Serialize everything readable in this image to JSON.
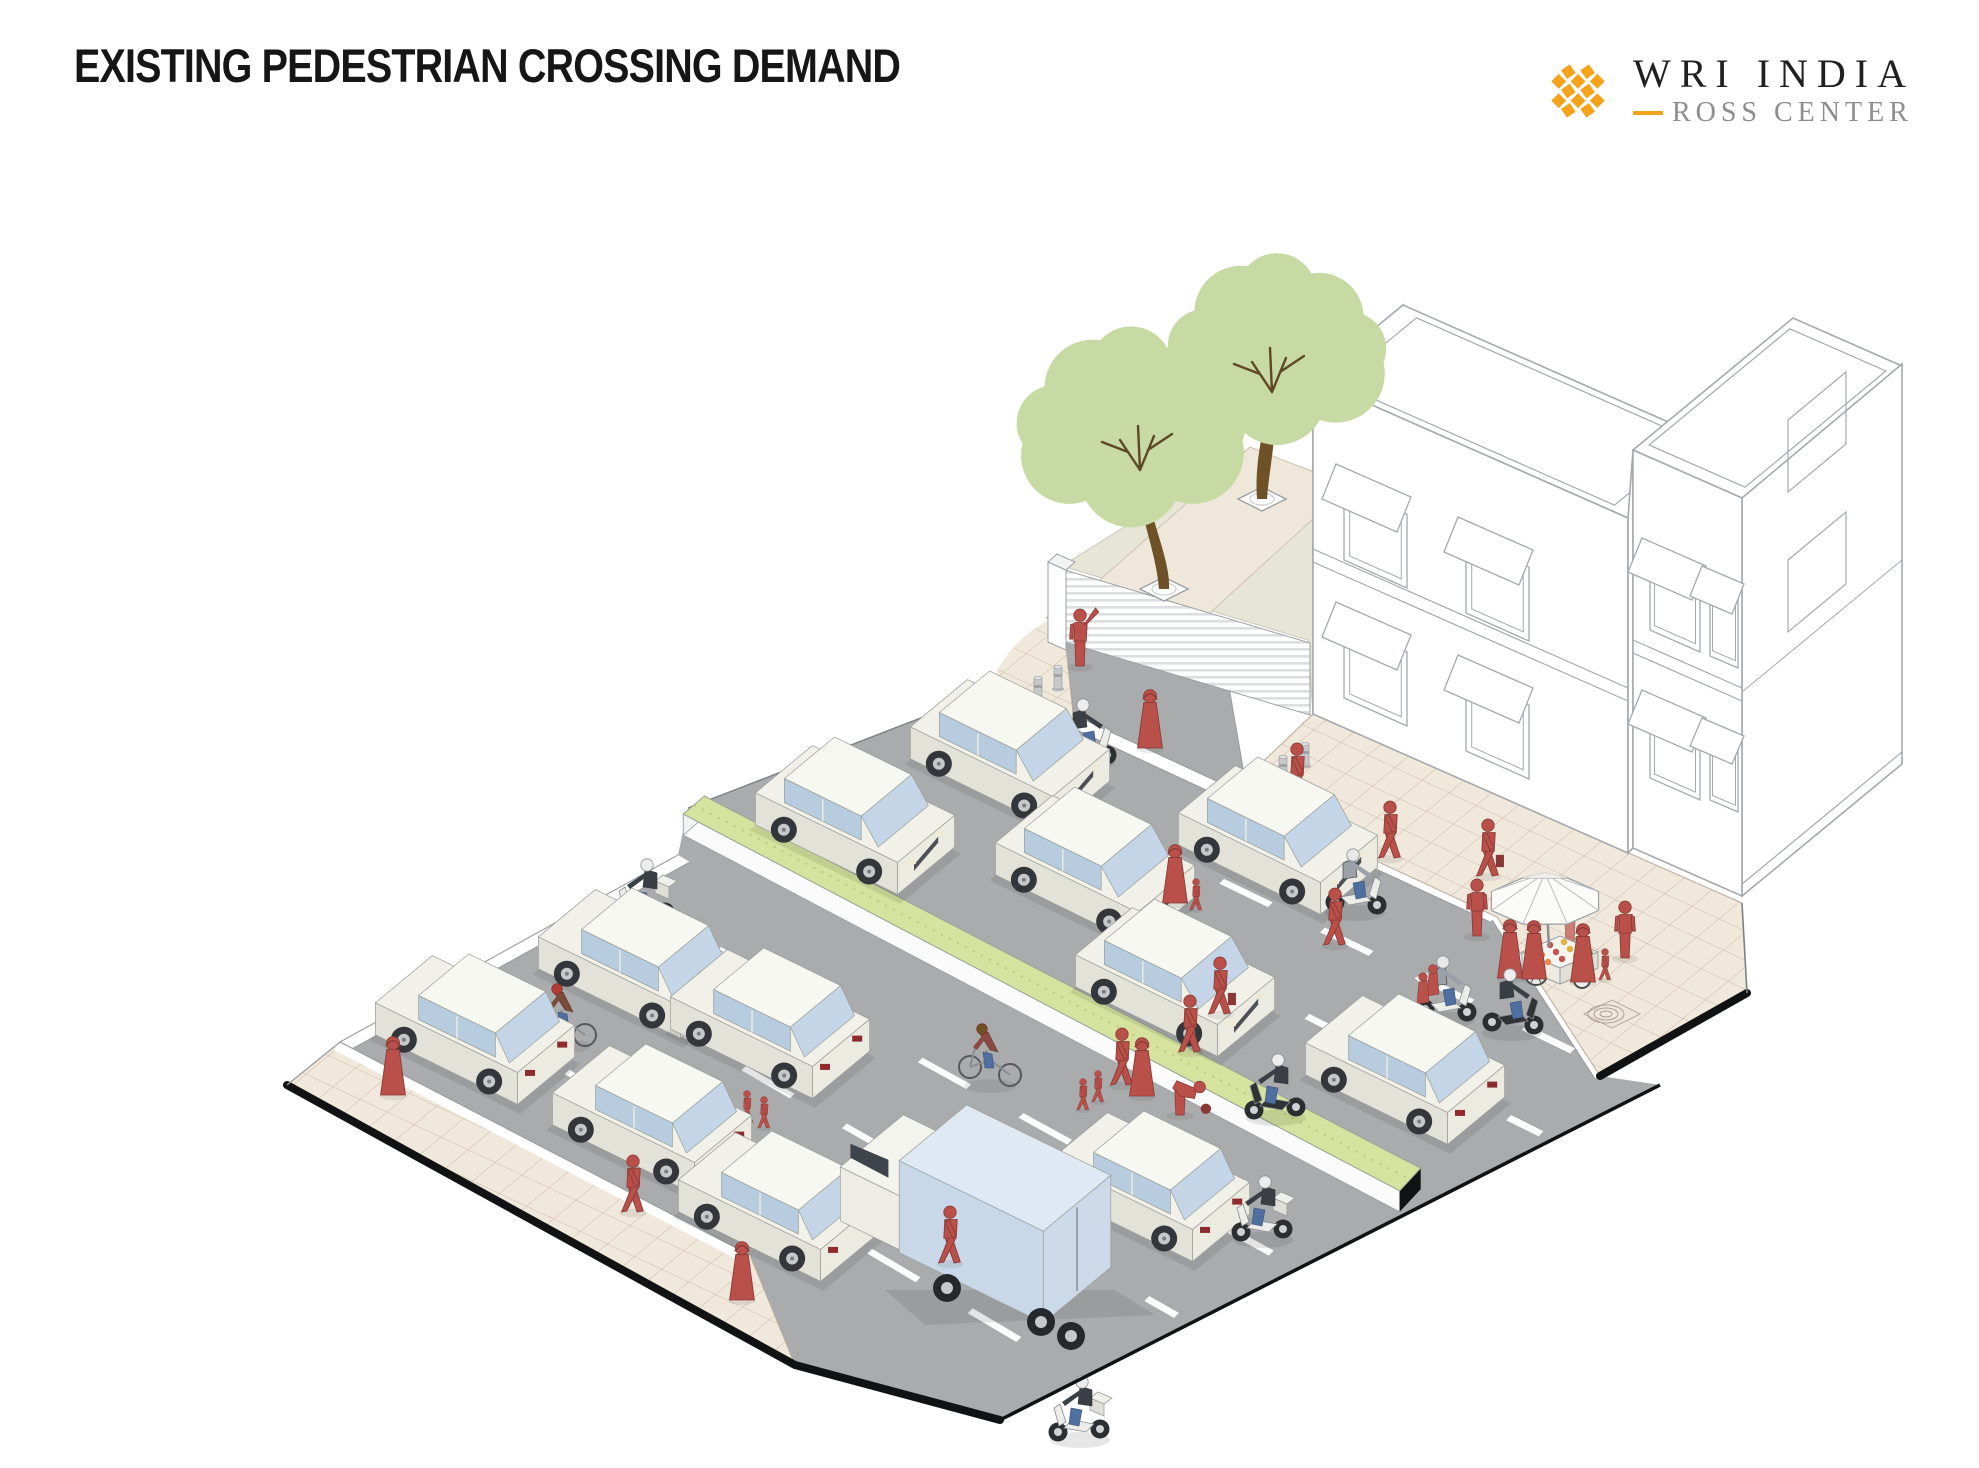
{
  "header": {
    "title": "EXISTING PEDESTRIAN CROSSING DEMAND"
  },
  "logo": {
    "line1": "WRI INDIA",
    "line2": "ROSS CENTER",
    "accent_gold": "#F5A31C",
    "text_dark": "#221f20",
    "text_gray": "#8d8d8d"
  },
  "scene": {
    "description": "Isometric street illustration of pedestrians crossing a busy divided road mid-block near a gated compound, trees, buildings and a street vendor",
    "colors": {
      "road": "#A9ABAD",
      "sidewalk": "#F0E8DB",
      "sidewalk_grid": "#CDB2A6",
      "path_tan": "#EFE7D9",
      "compound_green": "#E7E5D6",
      "median_green": "#D6E39E",
      "people_red": "#B9504A",
      "people_red_dark": "#8A3835",
      "tree_green": "#C8DAA4",
      "trunk_brown": "#6E5127",
      "car_body": "#EFEFE7",
      "car_glass": "#B7CCDF",
      "truck_box": "#C8D8E8",
      "building_line": "#A5A9AD",
      "edge_black": "#111214",
      "lane_white": "#FDFDFD"
    },
    "counts": {
      "cars": 12,
      "two_wheelers": 9,
      "bicycles": 2,
      "trucks": 1,
      "pedestrians": 30,
      "trees": 2,
      "bollards": 5
    },
    "median": {
      "u0": 142,
      "u1": 938,
      "v0": 338,
      "v1": 366,
      "wallH": 21
    },
    "lane_markings": [
      {
        "v": 175,
        "u0": 245,
        "u1": 975
      },
      {
        "v": 258,
        "u0": 185,
        "u1": 1005
      },
      {
        "v": 475,
        "u0": 160,
        "u1": 900
      },
      {
        "v": 570,
        "u0": 155,
        "u1": 860
      },
      {
        "v": 665,
        "u0": 150,
        "u1": 820
      }
    ],
    "cars": [
      {
        "x": 1010,
        "y": 772,
        "d": 1
      },
      {
        "x": 855,
        "y": 838,
        "d": 1
      },
      {
        "x": 1095,
        "y": 888,
        "d": 1
      },
      {
        "x": 1175,
        "y": 1000,
        "d": 1
      },
      {
        "x": 1278,
        "y": 858,
        "d": 1
      },
      {
        "x": 1405,
        "y": 1088,
        "d": -1
      },
      {
        "x": 475,
        "y": 1048,
        "d": -1
      },
      {
        "x": 638,
        "y": 982,
        "d": -1
      },
      {
        "x": 652,
        "y": 1138,
        "d": -1
      },
      {
        "x": 770,
        "y": 1042,
        "d": -1
      },
      {
        "x": 778,
        "y": 1225,
        "d": -1
      },
      {
        "x": 1150,
        "y": 1205,
        "d": -1
      }
    ],
    "trucks": [
      {
        "x": 1005,
        "y": 1260,
        "d": -1
      }
    ],
    "scooters": [
      {
        "x": 1085,
        "y": 755,
        "d": 1,
        "body": "white",
        "box": true,
        "rider": "dark"
      },
      {
        "x": 645,
        "y": 915,
        "d": -1,
        "body": "white",
        "box": true,
        "rider": "dark"
      },
      {
        "x": 809,
        "y": 805,
        "d": -1,
        "body": "black",
        "box": true,
        "rider": "dark"
      },
      {
        "x": 1355,
        "y": 905,
        "d": 1,
        "body": "white",
        "box": false,
        "rider": "gray"
      },
      {
        "x": 1445,
        "y": 1012,
        "d": 1,
        "body": "white",
        "box": true,
        "rider": "gray",
        "pass": true
      },
      {
        "x": 1512,
        "y": 1025,
        "d": 1,
        "body": "black",
        "box": false,
        "rider": "dark"
      },
      {
        "x": 1276,
        "y": 1110,
        "d": -1,
        "body": "black",
        "box": false,
        "rider": "dark"
      },
      {
        "x": 1263,
        "y": 1232,
        "d": -1,
        "body": "white",
        "box": true,
        "rider": "dark"
      },
      {
        "x": 1080,
        "y": 1432,
        "d": -1,
        "body": "white",
        "box": true,
        "rider": "dark"
      }
    ],
    "bicycles": [
      {
        "x": 565,
        "y": 1040,
        "d": -1,
        "jacket": "#7A4A3A",
        "helmet": "#B23C36"
      },
      {
        "x": 990,
        "y": 1080,
        "d": -1,
        "jacket": "#8A4A42",
        "helmet": "#6E5127"
      }
    ],
    "people": [
      {
        "x": 1080,
        "y": 666,
        "k": "guard"
      },
      {
        "x": 1150,
        "y": 748,
        "k": "robe"
      },
      {
        "x": 1297,
        "y": 800,
        "k": "walk"
      },
      {
        "x": 1390,
        "y": 858,
        "k": "walk"
      },
      {
        "x": 1488,
        "y": 876,
        "k": "carry"
      },
      {
        "x": 1477,
        "y": 936,
        "k": "stand"
      },
      {
        "x": 1570,
        "y": 941,
        "k": "stand",
        "o": 0.7
      },
      {
        "x": 1510,
        "y": 978,
        "k": "robe"
      },
      {
        "x": 1534,
        "y": 979,
        "k": "robe"
      },
      {
        "x": 1583,
        "y": 982,
        "k": "robe"
      },
      {
        "x": 1605,
        "y": 980,
        "k": "child"
      },
      {
        "x": 1625,
        "y": 958,
        "k": "stand"
      },
      {
        "x": 1175,
        "y": 903,
        "k": "robe"
      },
      {
        "x": 1196,
        "y": 910,
        "k": "child"
      },
      {
        "x": 1335,
        "y": 945,
        "k": "walk"
      },
      {
        "x": 1220,
        "y": 1014,
        "k": "carry"
      },
      {
        "x": 1190,
        "y": 1052,
        "k": "walk"
      },
      {
        "x": 747,
        "y": 1122,
        "k": "child"
      },
      {
        "x": 764,
        "y": 1128,
        "k": "child"
      },
      {
        "x": 1122,
        "y": 1085,
        "k": "walk"
      },
      {
        "x": 1142,
        "y": 1096,
        "k": "robe"
      },
      {
        "x": 1098,
        "y": 1102,
        "k": "child"
      },
      {
        "x": 1083,
        "y": 1110,
        "k": "child"
      },
      {
        "x": 1180,
        "y": 1115,
        "k": "bend"
      },
      {
        "x": 930,
        "y": 1230,
        "k": "walk"
      },
      {
        "x": 950,
        "y": 1263,
        "k": "walk"
      },
      {
        "x": 912,
        "y": 1196,
        "k": "robe"
      },
      {
        "x": 393,
        "y": 1095,
        "k": "robe"
      },
      {
        "x": 633,
        "y": 1212,
        "k": "walk"
      },
      {
        "x": 742,
        "y": 1300,
        "k": "robe"
      }
    ],
    "trees": [
      {
        "px": 1164,
        "py": 589,
        "tx": 1140,
        "ty": 470,
        "cx": 1131,
        "cy": 432,
        "r": 88
      },
      {
        "px": 1262,
        "py": 499,
        "tx": 1272,
        "ty": 392,
        "cx": 1277,
        "cy": 354,
        "r": 84
      }
    ],
    "bollards": [
      {
        "x": 1038,
        "y": 700
      },
      {
        "x": 1058,
        "y": 689
      },
      {
        "x": 1260,
        "y": 792
      },
      {
        "x": 1283,
        "y": 779
      },
      {
        "x": 1305,
        "y": 766
      }
    ],
    "vendor": {
      "umbrella": {
        "x": 1545,
        "y": 901
      },
      "cart": {
        "x": 1558,
        "y": 944
      }
    },
    "drain": {
      "x": 1612,
      "y": 1014
    }
  }
}
